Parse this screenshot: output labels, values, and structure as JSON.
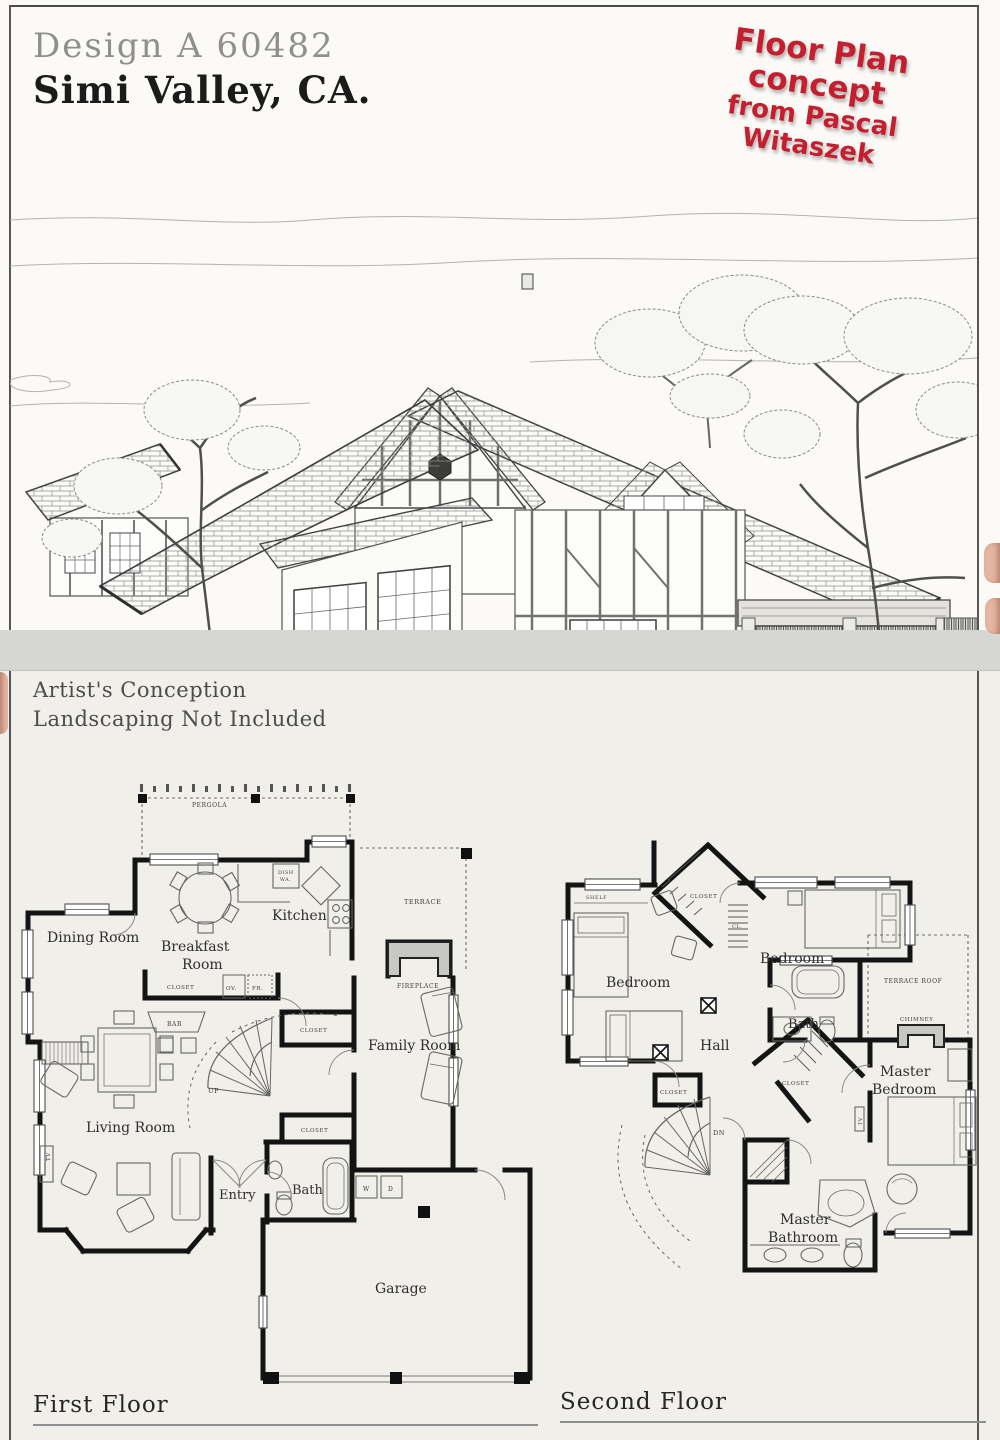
{
  "header": {
    "design_no": "Design A 60482",
    "location": "Simi Valley, CA."
  },
  "stamp": {
    "line1": "Floor Plan concept",
    "line2": "from Pascal Witaszek",
    "color": "#c41f2f"
  },
  "caption": {
    "line1": "Artist's Conception",
    "line2": "Landscaping Not Included"
  },
  "first_floor": {
    "title": "First Floor",
    "labels": {
      "pergola": "PERGOLA",
      "terrace": "TERRACE",
      "kitchen": "Kitchen",
      "breakfast_line1": "Breakfast",
      "breakfast_line2": "Room",
      "dining_room": "Dining Room",
      "living_room": "Living Room",
      "family_room": "Family Room",
      "fireplace": "FIREPLACE",
      "bar": "BAR",
      "up": "UP",
      "entry": "Entry",
      "bath": "Bath",
      "garage": "Garage",
      "closet": "CLOSET",
      "dish_line1": "DISH",
      "dish_line2": "WA.",
      "oven": "OV.",
      "fridge": "FR.",
      "washer": "W",
      "dryer": "D",
      "tv": "TV"
    }
  },
  "second_floor": {
    "title": "Second Floor",
    "labels": {
      "shelf": "SHELF",
      "closet": "CLOSET",
      "cl": "CL.",
      "bedroom": "Bedroom",
      "bath": "Bath",
      "hall": "Hall",
      "terrace_roof": "TERRACE ROOF",
      "chimney": "CHIMNEY",
      "master": "Master",
      "master_bedroom_line2": "Bedroom",
      "master_bathroom_line2": "Bathroom",
      "dn": "DN",
      "tv": "TV"
    }
  }
}
